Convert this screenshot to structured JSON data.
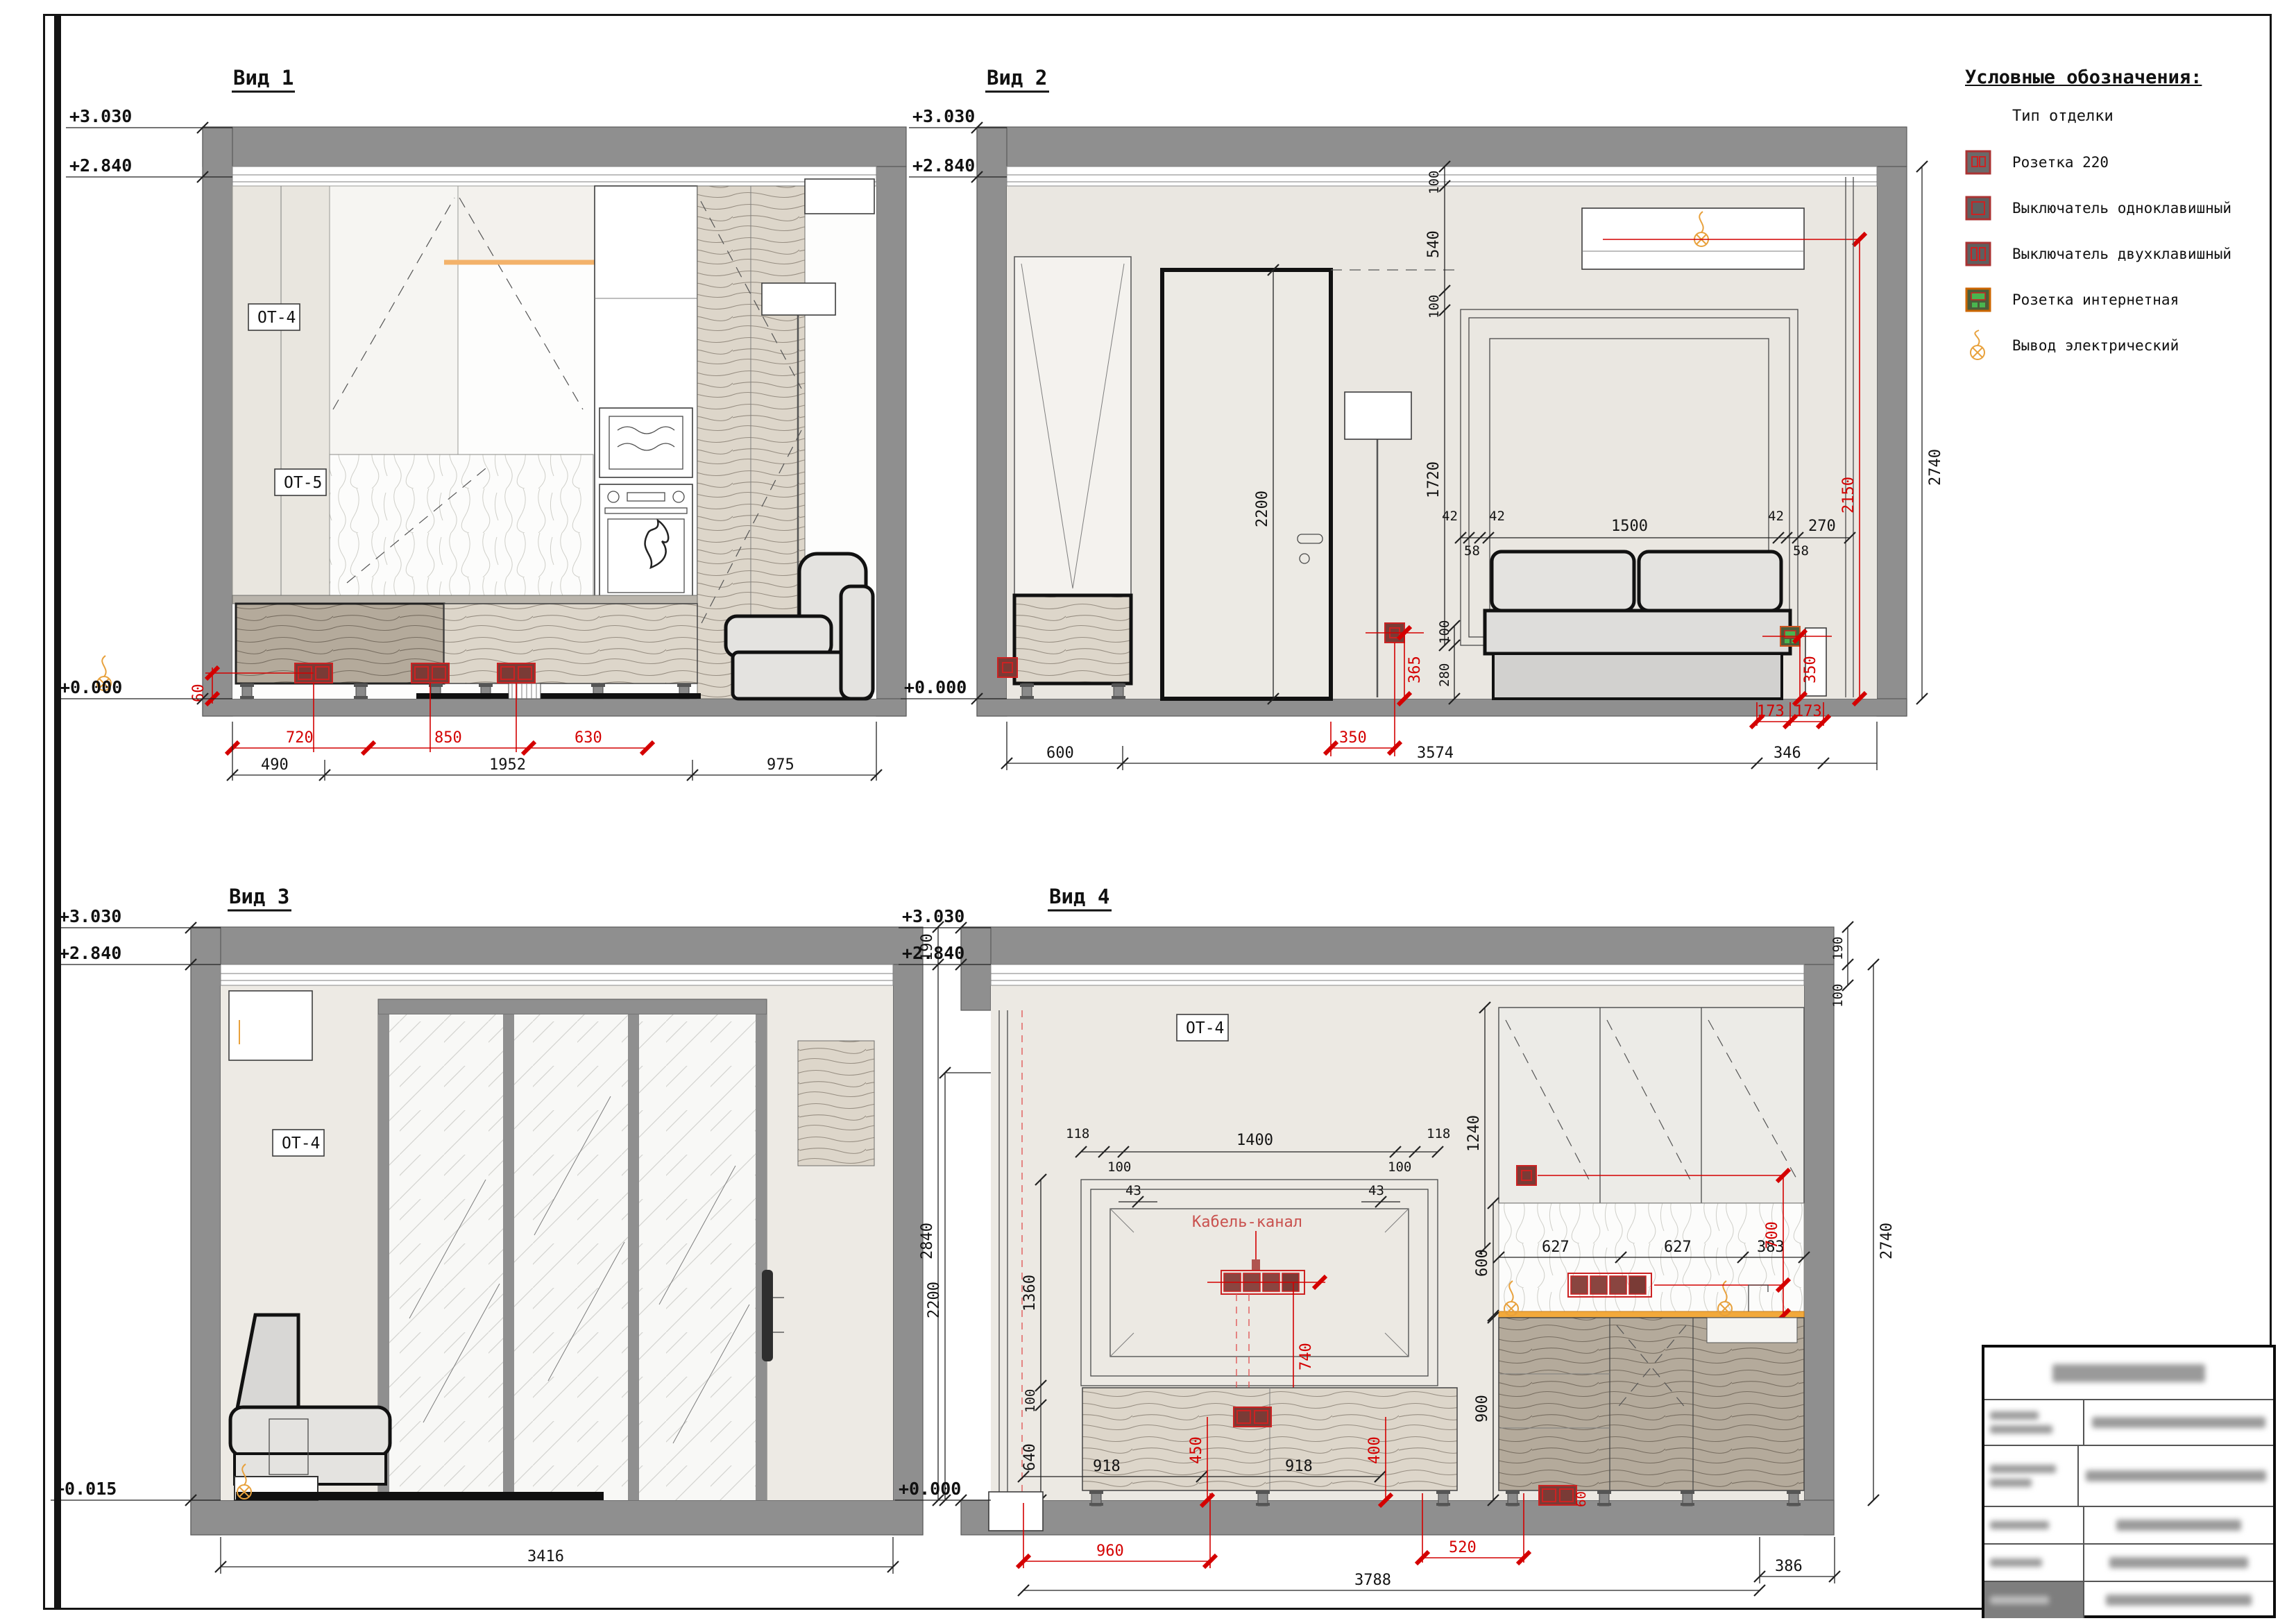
{
  "legend": {
    "title": "Условные обозначения:",
    "subtitle": "Тип отделки",
    "items": [
      {
        "icon": "outlet-220-icon",
        "label": "Розетка 220"
      },
      {
        "icon": "switch-single-icon",
        "label": "Выключатель одноклавишный"
      },
      {
        "icon": "switch-double-icon",
        "label": "Выключатель двухклавишный"
      },
      {
        "icon": "outlet-internet-icon",
        "label": "Розетка интернетная"
      },
      {
        "icon": "electrical-output-icon",
        "label": "Вывод электрический"
      }
    ]
  },
  "colors": {
    "dimension_red": "#d40000",
    "wall_gray": "#8f8f8f",
    "accent_orange": "#e8a13c"
  },
  "v1": {
    "title": "Вид 1",
    "l3030": "+3.030",
    "l2840": "+2.840",
    "l0": "+0.000",
    "ot4": "ОТ-4",
    "ot5": "ОТ-5",
    "d720": "720",
    "d850": "850",
    "d630": "630",
    "d490": "490",
    "d1952": "1952",
    "d975": "975",
    "d60": "60"
  },
  "v2": {
    "title": "Вид 2",
    "l3030": "+3.030",
    "l2840": "+2.840",
    "l0": "+0.000",
    "v100a": "100",
    "v540": "540",
    "v100b": "100",
    "v1720": "1720",
    "h42a": "42",
    "h58a": "58",
    "h42b": "42",
    "h1500": "1500",
    "h42c": "42",
    "h58b": "58",
    "h270": "270",
    "v100c": "100",
    "v280": "280",
    "v2200": "2200",
    "v2740": "2740",
    "r2150": "2150",
    "r365": "365",
    "r350a": "350",
    "r350b": "350",
    "r173a": "173",
    "r173b": "173",
    "b600": "600",
    "b3574": "3574",
    "b346": "346"
  },
  "v3": {
    "title": "Вид 3",
    "l3030": "+3.030",
    "l2840": "+2.840",
    "l0015": "+0.015",
    "ot4": "ОТ-4",
    "v190": "190",
    "v2840": "2840",
    "b3416": "3416"
  },
  "v4": {
    "title": "Вид 4",
    "l3030": "+3.030",
    "l2840": "+2.840",
    "l0": "+0.000",
    "ot4": "ОТ-4",
    "cable": "Кабель-канал",
    "h118a": "118",
    "h100a": "100",
    "h1400": "1400",
    "h100b": "100",
    "h118b": "118",
    "v1240": "1240",
    "v1360": "1360",
    "v100l": "100",
    "v640": "640",
    "h43a": "43",
    "h43b": "43",
    "r740": "740",
    "r450": "450",
    "r400": "400",
    "r60": "60",
    "h918a": "918",
    "h918b": "918",
    "r960": "960",
    "b3788": "3788",
    "b386": "386",
    "r520": "520",
    "h627a": "627",
    "h627b": "627",
    "h383": "383",
    "v600": "600",
    "v900": "900",
    "r700": "700",
    "v190": "190",
    "v100r": "100",
    "v2740": "2740",
    "v2200": "2200"
  }
}
